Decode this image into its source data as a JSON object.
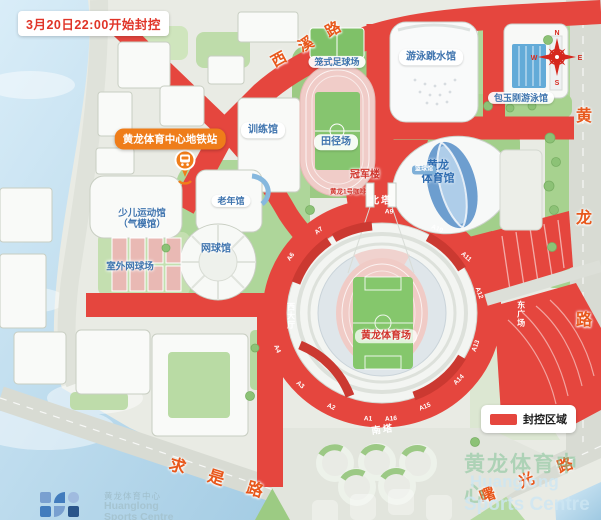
{
  "banner": {
    "text": "3月20日22:00开始封控"
  },
  "metro": {
    "station_label": "黄龙体育中心地铁站"
  },
  "venues": {
    "caged_football": "笼式足球场",
    "swim_dive": "游泳跳水馆",
    "pao_pool": "包玉刚游泳馆",
    "training_hall": "训练馆",
    "track_field": "田径场",
    "champion_building": "冠军楼",
    "coffee": "黄龙1号咖啡",
    "gym_line1": "黄龙",
    "gym_line2": "体育馆",
    "basketball": "篮球馆",
    "senior_hall": "老年馆",
    "tennis_hall": "网球馆",
    "children_line1": "少儿运动馆",
    "children_line2": "（气模馆）",
    "outdoor_tennis": "室外网球场",
    "stadium": "黄龙体育场"
  },
  "ring": {
    "north_tower": "北塔",
    "south_tower": "南塔",
    "west_hall": "西大厅",
    "east_plaza": "东广场",
    "gates": [
      "A1",
      "A2",
      "A3",
      "A4",
      "A6",
      "A7",
      "A9",
      "A10",
      "A11",
      "A12",
      "A13",
      "A14",
      "A15",
      "A16"
    ]
  },
  "roads": {
    "xixi": "西溪路",
    "huanglong": "黄龙路",
    "qiushi": "求是路",
    "shuguang": "曙光路"
  },
  "legend": {
    "label": "封控区域",
    "closure_color": "#e5463e"
  },
  "compass": {
    "n": "N",
    "e": "E",
    "s": "S",
    "w": "W"
  },
  "footer_logo": {
    "cn": "黄龙体育中心",
    "en1": "Huanglong",
    "en2": "Sports Centre"
  },
  "watermark": {
    "cn": "黄龙体育中心",
    "en1": "Huanglong",
    "en2": "Sports Centre"
  },
  "colors": {
    "closure_red": "#e5463e",
    "banner_red": "#e03428",
    "metro_orange": "#ef7d1a",
    "road_name_orange": "#e8581c",
    "water_blue": "#a8cfe6",
    "land": "#e9ebe4",
    "green": "#aad492",
    "venue_blue_text": "#3f74ae"
  }
}
